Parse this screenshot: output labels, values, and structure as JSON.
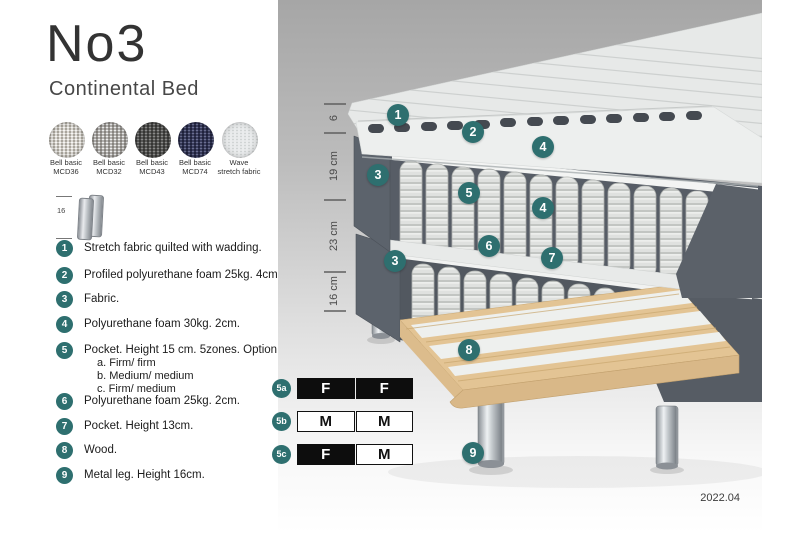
{
  "header": {
    "title": "No3",
    "subtitle": "Continental Bed"
  },
  "swatches": {
    "items": [
      {
        "line1": "Bell basic",
        "line2": "MCD36"
      },
      {
        "line1": "Bell basic",
        "line2": "MCD32"
      },
      {
        "line1": "Bell basic",
        "line2": "MCD43"
      },
      {
        "line1": "Bell basic",
        "line2": "MCD74"
      },
      {
        "line1": "Wave",
        "line2": "stretch fabric"
      }
    ]
  },
  "leg_detail": {
    "height_label": "16"
  },
  "legend": {
    "items": [
      {
        "num": "1",
        "text": "Stretch fabric quilted with wadding."
      },
      {
        "num": "2",
        "text": "Profiled polyurethane foam 25kg. 4cm."
      },
      {
        "num": "3",
        "text": "Fabric."
      },
      {
        "num": "4",
        "text": "Polyurethane foam 30kg. 2cm."
      },
      {
        "num": "5",
        "text": "Pocket. Height 15 cm. 5zones. Option:",
        "sub": [
          "a. Firm/ firm",
          "b. Medium/ medium",
          "c. Firm/ medium"
        ]
      },
      {
        "num": "6",
        "text": "Polyurethane foam 25kg. 2cm."
      },
      {
        "num": "7",
        "text": "Pocket. Height 13cm."
      },
      {
        "num": "8",
        "text": "Wood."
      },
      {
        "num": "9",
        "text": "Metal leg. Height 16cm."
      }
    ]
  },
  "firmness": {
    "rows": [
      {
        "label": "5a",
        "left": "F",
        "right": "F"
      },
      {
        "label": "5b",
        "left": "M",
        "right": "M"
      },
      {
        "label": "5c",
        "left": "F",
        "right": "M"
      }
    ]
  },
  "diagram": {
    "dimensions": [
      {
        "label": "6"
      },
      {
        "label": "19 cm"
      },
      {
        "label": "23 cm"
      },
      {
        "label": "16 cm"
      }
    ],
    "callouts": [
      {
        "label": "1"
      },
      {
        "label": "2"
      },
      {
        "label": "4"
      },
      {
        "label": "3"
      },
      {
        "label": "5"
      },
      {
        "label": "4"
      },
      {
        "label": "6"
      },
      {
        "label": "7"
      },
      {
        "label": "3"
      },
      {
        "label": "8"
      },
      {
        "label": "9"
      }
    ]
  },
  "footer": {
    "date": "2022.04"
  },
  "colors": {
    "accent_teal": "#2e6f6f",
    "fabric_gray": "#5b6169",
    "wood": "#e3c494"
  }
}
